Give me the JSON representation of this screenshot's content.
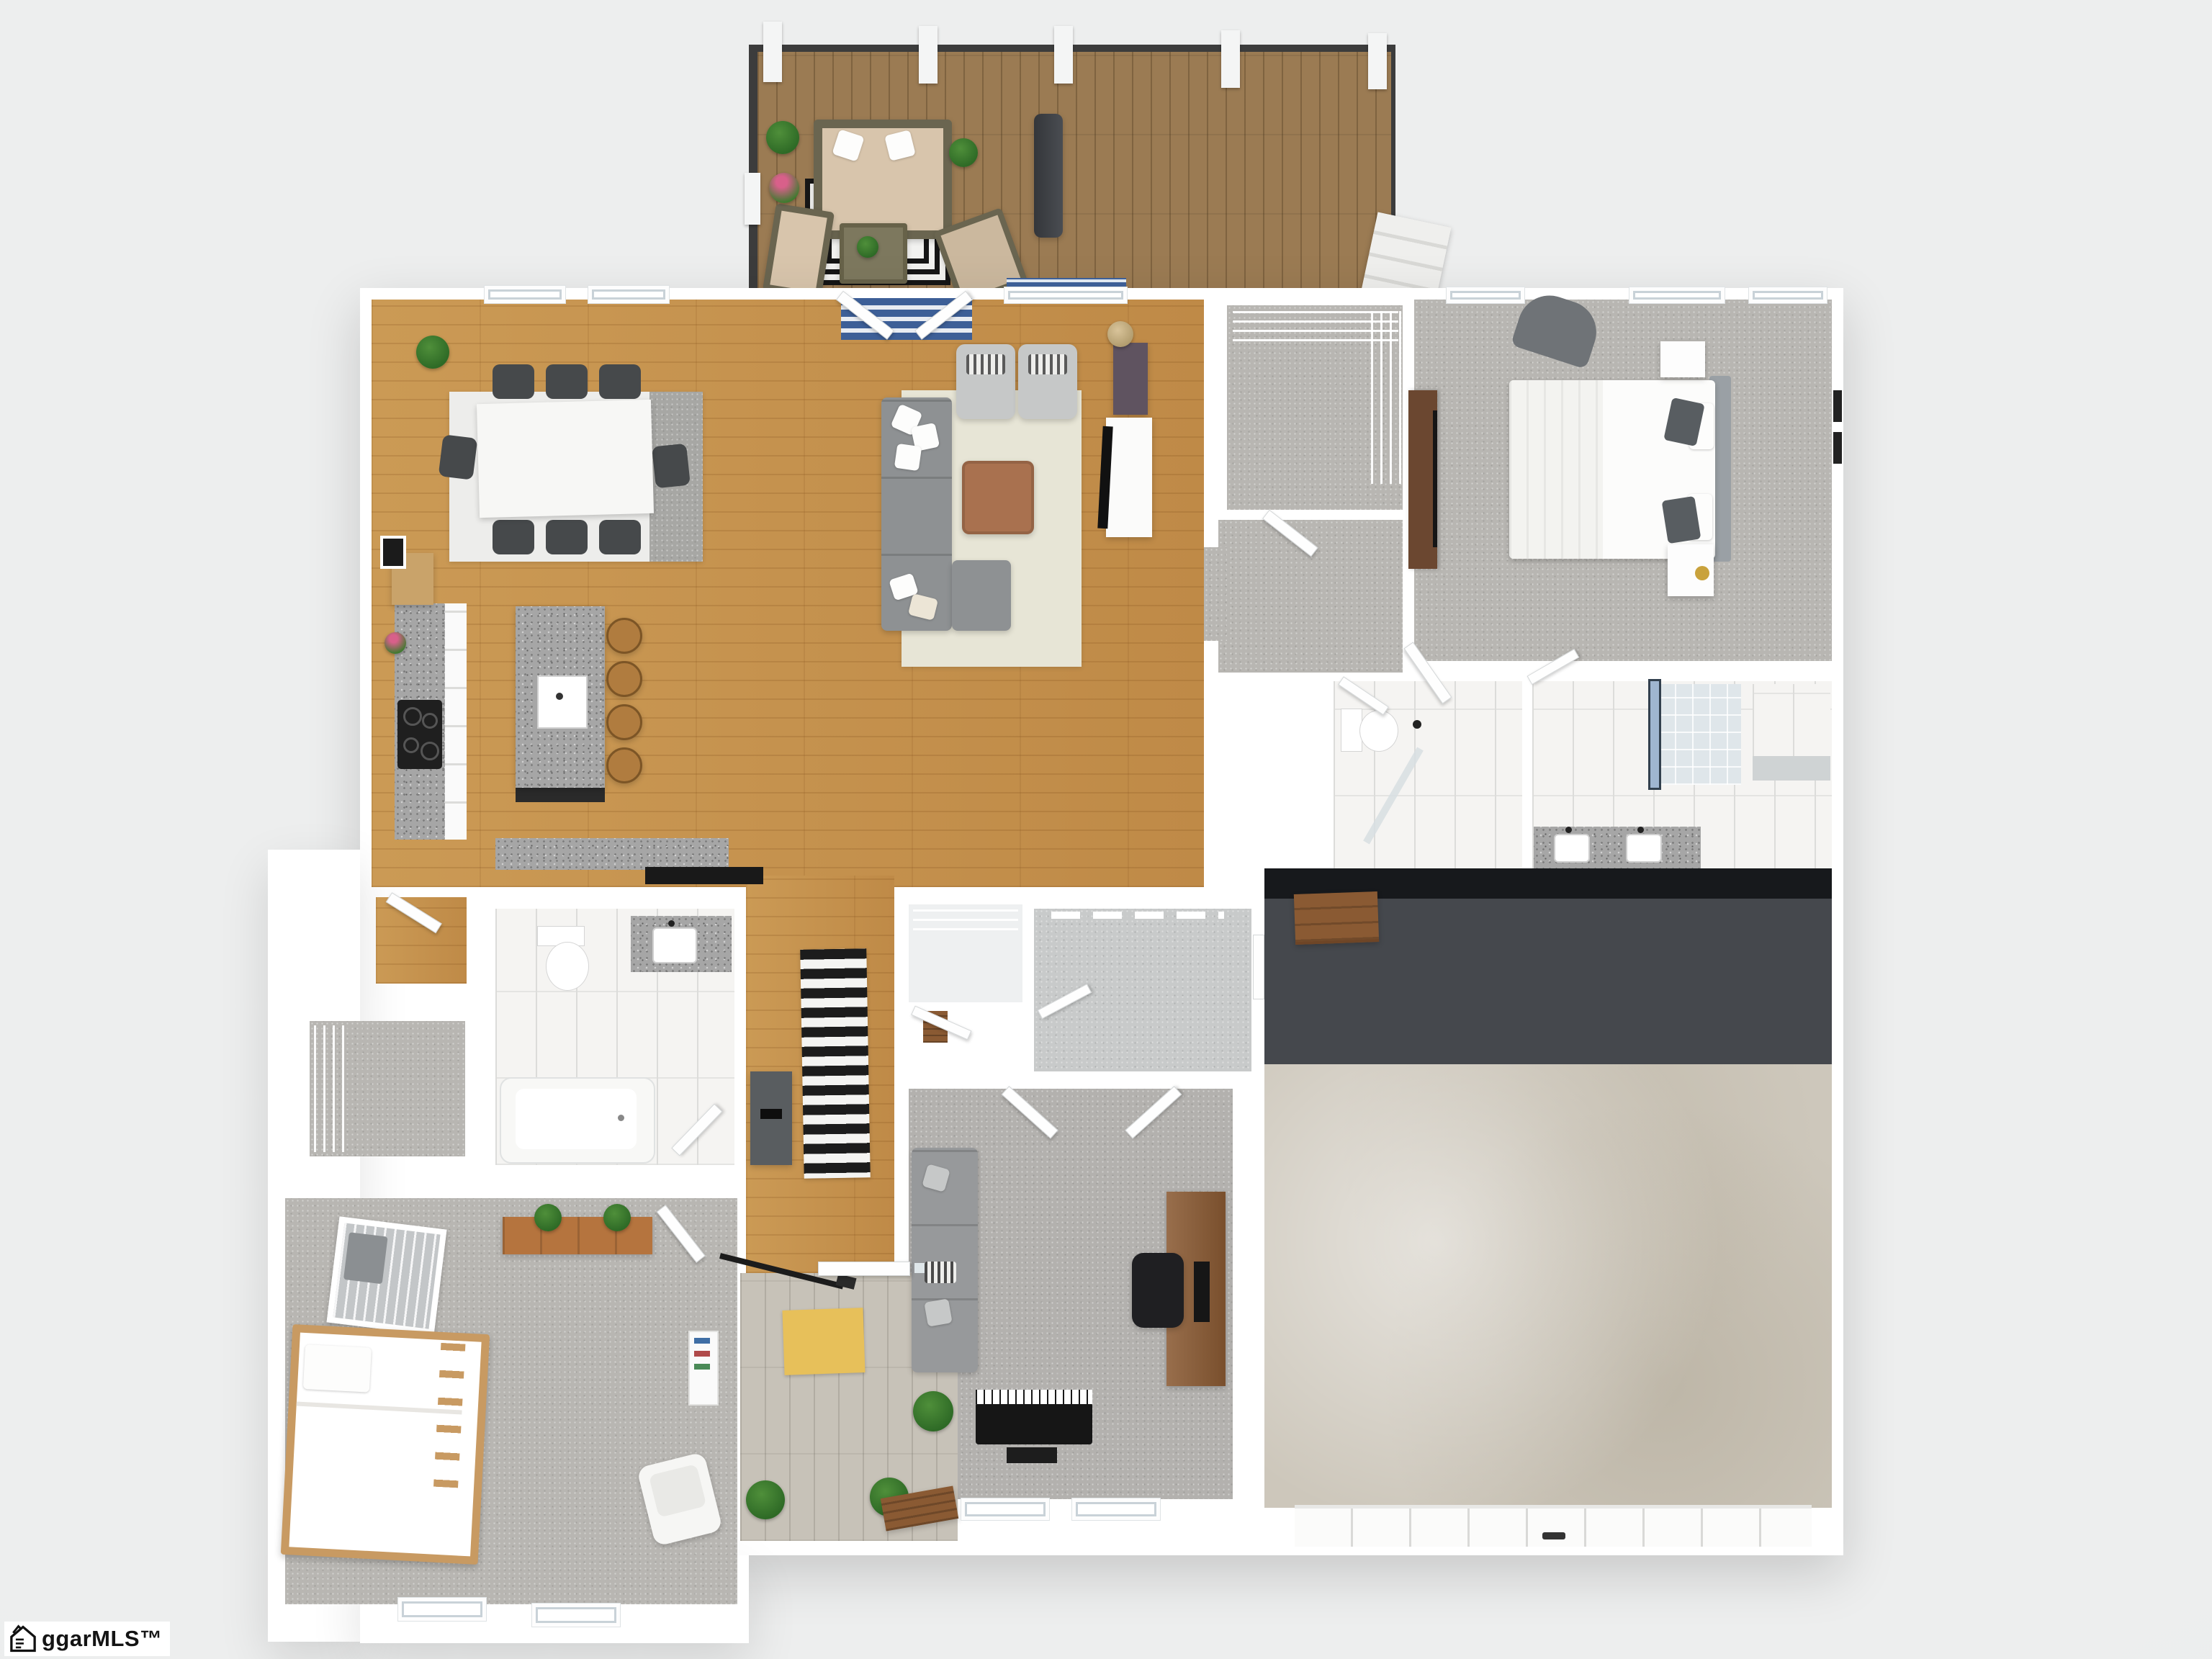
{
  "watermark": {
    "text": "ggarMLS™",
    "logo": "house-pencil-icon"
  },
  "scene": {
    "type": "3d-floorplan-render",
    "background_color": "#e9ebec",
    "wall_color": "#ffffff",
    "palette": {
      "hardwood": "#c6944f",
      "deck_wood": "#9b7b53",
      "porch_wood": "#c7c2b8",
      "bedroom_carpet": "#b8b6b2",
      "office_carpet": "#b3b1ae",
      "tile": "#f5f4f2",
      "granite_counter": "#a6a6a6",
      "garage_concrete": "#cdc7bb",
      "garage_accent_wall": "#45484d",
      "sofa_gray": "#8e9193",
      "ottoman_brown": "#a9714f",
      "entry_rug_blue": "#3d5f97",
      "door_mat_yellow": "#e7c05a",
      "stripe_runner_black": "#1c1c1c",
      "stripe_runner_white": "#f4f4f2"
    },
    "rooms": [
      {
        "id": "deck"
      },
      {
        "id": "great-room"
      },
      {
        "id": "kitchen"
      },
      {
        "id": "dining-area"
      },
      {
        "id": "living-area"
      },
      {
        "id": "master-bedroom"
      },
      {
        "id": "walk-in-closet"
      },
      {
        "id": "hallway"
      },
      {
        "id": "hall-bathroom"
      },
      {
        "id": "master-bathroom"
      },
      {
        "id": "garage"
      },
      {
        "id": "mudroom"
      },
      {
        "id": "coat-closet"
      },
      {
        "id": "office"
      },
      {
        "id": "nursery-bedroom"
      },
      {
        "id": "pantry"
      },
      {
        "id": "linen-closet"
      },
      {
        "id": "main-bathroom"
      },
      {
        "id": "entry-porch"
      }
    ]
  }
}
